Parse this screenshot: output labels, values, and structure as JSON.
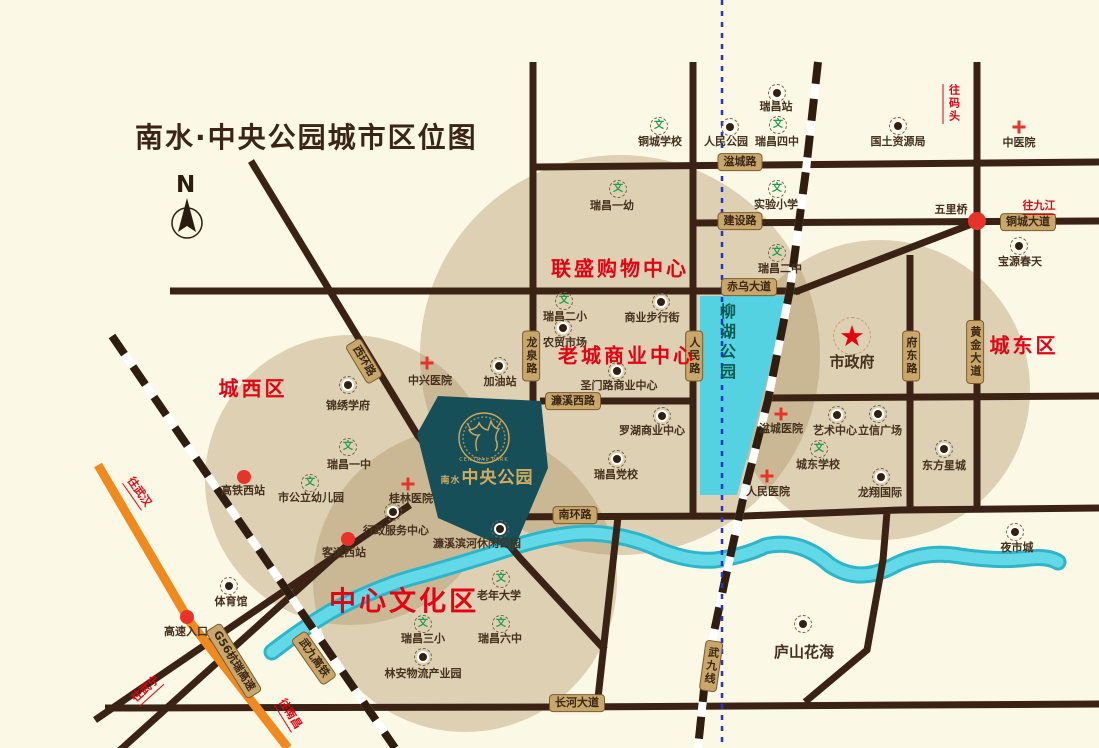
{
  "title": "南水·中央公园城市区位图",
  "compass": {
    "label": "N"
  },
  "logo": {
    "en": "CENTRAL PARK",
    "prefix": "南水",
    "name": "中央公园"
  },
  "lake": {
    "label": "柳湖公园"
  },
  "icons": {
    "school_glyph": "文",
    "star_glyph": "★"
  },
  "colors": {
    "road": "#3a2314",
    "river": "#54d2e2",
    "beige": "#d8c7a8",
    "red": "#e60012",
    "badge_bg": "#c9a76a",
    "teal": "#174f58",
    "gold": "#cfa95c",
    "orange": "#f08a1e",
    "rail_blue": "#2531da"
  },
  "districts": [
    {
      "text": "城西区",
      "x": 253,
      "y": 387,
      "size": 20
    },
    {
      "text": "联盛购物中心",
      "x": 620,
      "y": 267,
      "size": 20
    },
    {
      "text": "老城商业中心",
      "x": 627,
      "y": 354,
      "size": 20
    },
    {
      "text": "城东区",
      "x": 1024,
      "y": 344,
      "size": 20
    },
    {
      "text": "中心文化区",
      "x": 404,
      "y": 599,
      "size": 27
    }
  ],
  "directions": [
    {
      "text": "往码头",
      "x": 952,
      "y": 104,
      "mode": "v"
    },
    {
      "text": "往九江",
      "x": 1039,
      "y": 206,
      "mode": "h"
    },
    {
      "text": "往武汉",
      "x": 139,
      "y": 492,
      "mode": "h",
      "rot": 55
    },
    {
      "text": "往武宁",
      "x": 146,
      "y": 689,
      "mode": "h",
      "rot": -42
    },
    {
      "text": "往南昌",
      "x": 290,
      "y": 714,
      "mode": "h",
      "rot": 58
    }
  ],
  "road_labels": [
    {
      "text": "湓城路",
      "x": 740,
      "y": 162,
      "mode": "h"
    },
    {
      "text": "建设路",
      "x": 740,
      "y": 221,
      "mode": "h"
    },
    {
      "text": "赤乌大道",
      "x": 749,
      "y": 287,
      "mode": "h"
    },
    {
      "text": "铜城大道",
      "x": 1028,
      "y": 222,
      "mode": "h"
    },
    {
      "text": "西环路",
      "x": 364,
      "y": 361,
      "mode": "h",
      "rot": 59
    },
    {
      "text": "龙泉路",
      "x": 531,
      "y": 356,
      "mode": "v"
    },
    {
      "text": "人民路",
      "x": 694,
      "y": 356,
      "mode": "v"
    },
    {
      "text": "府东路",
      "x": 911,
      "y": 356,
      "mode": "v"
    },
    {
      "text": "黄金大道",
      "x": 975,
      "y": 352,
      "mode": "v"
    },
    {
      "text": "濂溪西路",
      "x": 573,
      "y": 401,
      "mode": "h"
    },
    {
      "text": "南环路",
      "x": 575,
      "y": 515,
      "mode": "h"
    },
    {
      "text": "长河大道",
      "x": 577,
      "y": 703,
      "mode": "h"
    },
    {
      "text": "G56杭瑞高速",
      "x": 234,
      "y": 661,
      "mode": "h",
      "rot": 58
    },
    {
      "text": "武九高铁",
      "x": 314,
      "y": 658,
      "mode": "h",
      "rot": 55
    },
    {
      "text": "武九线",
      "x": 711,
      "y": 666,
      "mode": "v",
      "rot": 8
    }
  ],
  "pois": [
    {
      "label": "瑞昌站",
      "icon": "dot",
      "ix": 777,
      "iy": 93,
      "lx": 776,
      "ly": 101
    },
    {
      "label": "人民公园",
      "icon": "dot",
      "ix": 730,
      "iy": 127,
      "lx": 726,
      "ly": 136
    },
    {
      "label": "铜城学校",
      "icon": "school",
      "ix": 659,
      "iy": 126,
      "lx": 660,
      "ly": 136
    },
    {
      "label": "瑞昌四中",
      "icon": "school",
      "ix": 778,
      "iy": 125,
      "lx": 777,
      "ly": 136
    },
    {
      "label": "国土资源局",
      "icon": "dot",
      "ix": 898,
      "iy": 126,
      "lx": 898,
      "ly": 136
    },
    {
      "label": "中医院",
      "icon": "hosp",
      "ix": 1019,
      "iy": 127,
      "lx": 1019,
      "ly": 137
    },
    {
      "label": "瑞昌一幼",
      "icon": "school",
      "ix": 618,
      "iy": 189,
      "lx": 612,
      "ly": 200
    },
    {
      "label": "实验小学",
      "icon": "school",
      "ix": 777,
      "iy": 189,
      "lx": 776,
      "ly": 199
    },
    {
      "label": "五里桥",
      "icon": "redbig",
      "ix": 977,
      "iy": 221,
      "lx": 951,
      "ly": 204
    },
    {
      "label": "宝源春天",
      "icon": "dot",
      "ix": 1019,
      "iy": 246,
      "lx": 1020,
      "ly": 256
    },
    {
      "label": "瑞昌二中",
      "icon": "school",
      "ix": 777,
      "iy": 253,
      "lx": 780,
      "ly": 263
    },
    {
      "label": "瑞昌二小",
      "icon": "school",
      "ix": 564,
      "iy": 301,
      "lx": 565,
      "ly": 311
    },
    {
      "label": "商业步行街",
      "icon": "dot",
      "ix": 661,
      "iy": 302,
      "lx": 652,
      "ly": 312
    },
    {
      "label": "农贸市场",
      "icon": "dot",
      "ix": 563,
      "iy": 328,
      "lx": 565,
      "ly": 337
    },
    {
      "label": "圣门路商业中心",
      "icon": "dot",
      "ix": 617,
      "iy": 371,
      "lx": 619,
      "ly": 380
    },
    {
      "label": "锦绣学府",
      "icon": "dot",
      "ix": 348,
      "iy": 385,
      "lx": 348,
      "ly": 400
    },
    {
      "label": "中兴医院",
      "icon": "hosp",
      "ix": 427,
      "iy": 363,
      "lx": 430,
      "ly": 375
    },
    {
      "label": "加油站",
      "icon": "dot",
      "ix": 499,
      "iy": 366,
      "lx": 500,
      "ly": 376
    },
    {
      "label": "瑞昌一中",
      "icon": "school",
      "ix": 348,
      "iy": 447,
      "lx": 349,
      "ly": 459
    },
    {
      "label": "市公立幼儿园",
      "icon": "school",
      "ix": 310,
      "iy": 483,
      "lx": 311,
      "ly": 492
    },
    {
      "label": "桂林医院",
      "icon": "hosp",
      "ix": 408,
      "iy": 484,
      "lx": 411,
      "ly": 493
    },
    {
      "label": "高铁西站",
      "icon": "red",
      "ix": 244,
      "iy": 477,
      "lx": 243,
      "ly": 485
    },
    {
      "label": "行政服务中心",
      "icon": "dot",
      "ix": 393,
      "iy": 512,
      "lx": 396,
      "ly": 525
    },
    {
      "label": "客运西站",
      "icon": "red",
      "ix": 348,
      "iy": 539,
      "lx": 344,
      "ly": 547
    },
    {
      "label": "体育馆",
      "icon": "dot",
      "ix": 229,
      "iy": 586,
      "lx": 231,
      "ly": 596
    },
    {
      "label": "高速入口",
      "icon": "red",
      "ix": 187,
      "iy": 617,
      "lx": 186,
      "ly": 626
    },
    {
      "label": "濂溪滨河休闲公园",
      "icon": "dot",
      "ix": 500,
      "iy": 529,
      "lx": 477,
      "ly": 538
    },
    {
      "label": "罗湖商业中心",
      "icon": "dot",
      "ix": 662,
      "iy": 416,
      "lx": 652,
      "ly": 425
    },
    {
      "label": "瑞昌党校",
      "icon": "dot",
      "ix": 617,
      "iy": 459,
      "lx": 616,
      "ly": 469
    },
    {
      "label": "湓城医院",
      "icon": "hosp",
      "ix": 781,
      "iy": 414,
      "lx": 781,
      "ly": 423
    },
    {
      "label": "艺术中心",
      "icon": "dot",
      "ix": 837,
      "iy": 415,
      "lx": 835,
      "ly": 425
    },
    {
      "label": "立信广场",
      "icon": "dot",
      "ix": 878,
      "iy": 414,
      "lx": 880,
      "ly": 425
    },
    {
      "label": "城东学校",
      "icon": "school",
      "ix": 819,
      "iy": 449,
      "lx": 818,
      "ly": 459
    },
    {
      "label": "人民医院",
      "icon": "hosp",
      "ix": 767,
      "iy": 476,
      "lx": 768,
      "ly": 486
    },
    {
      "label": "龙翔国际",
      "icon": "dot",
      "ix": 881,
      "iy": 477,
      "lx": 880,
      "ly": 487
    },
    {
      "label": "东方星城",
      "icon": "dot",
      "ix": 944,
      "iy": 449,
      "lx": 944,
      "ly": 460
    },
    {
      "label": "市政府",
      "icon": "star",
      "ix": 852,
      "iy": 336,
      "lx": 852,
      "ly": 354,
      "fs": 15
    },
    {
      "label": "老年大学",
      "icon": "school",
      "ix": 501,
      "iy": 579,
      "lx": 499,
      "ly": 590
    },
    {
      "label": "瑞昌三小",
      "icon": "school",
      "ix": 423,
      "iy": 624,
      "lx": 423,
      "ly": 633
    },
    {
      "label": "瑞昌六中",
      "icon": "school",
      "ix": 501,
      "iy": 624,
      "lx": 500,
      "ly": 633
    },
    {
      "label": "林安物流产业园",
      "icon": "dot",
      "ix": 423,
      "iy": 657,
      "lx": 423,
      "ly": 668
    },
    {
      "label": "庐山花海",
      "icon": "dot",
      "ix": 803,
      "iy": 624,
      "lx": 804,
      "ly": 644,
      "fs": 15
    },
    {
      "label": "夜市城",
      "icon": "dot",
      "ix": 1015,
      "iy": 532,
      "lx": 1017,
      "ly": 542
    }
  ]
}
